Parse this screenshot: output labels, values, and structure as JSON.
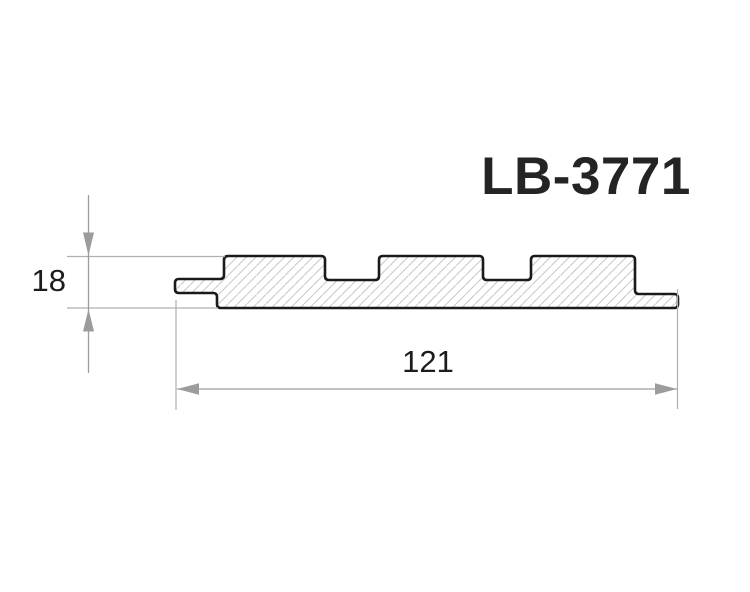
{
  "drawing": {
    "title": "LB-3771",
    "dimensions": {
      "height": {
        "value": "18"
      },
      "width": {
        "value": "121"
      }
    },
    "colors": {
      "background": "#ffffff",
      "outline": "#1a1a1a",
      "dimension_gray": "#9c9c9c",
      "hatch_gray": "#c8c8c8",
      "text": "#1c1c1c"
    }
  }
}
